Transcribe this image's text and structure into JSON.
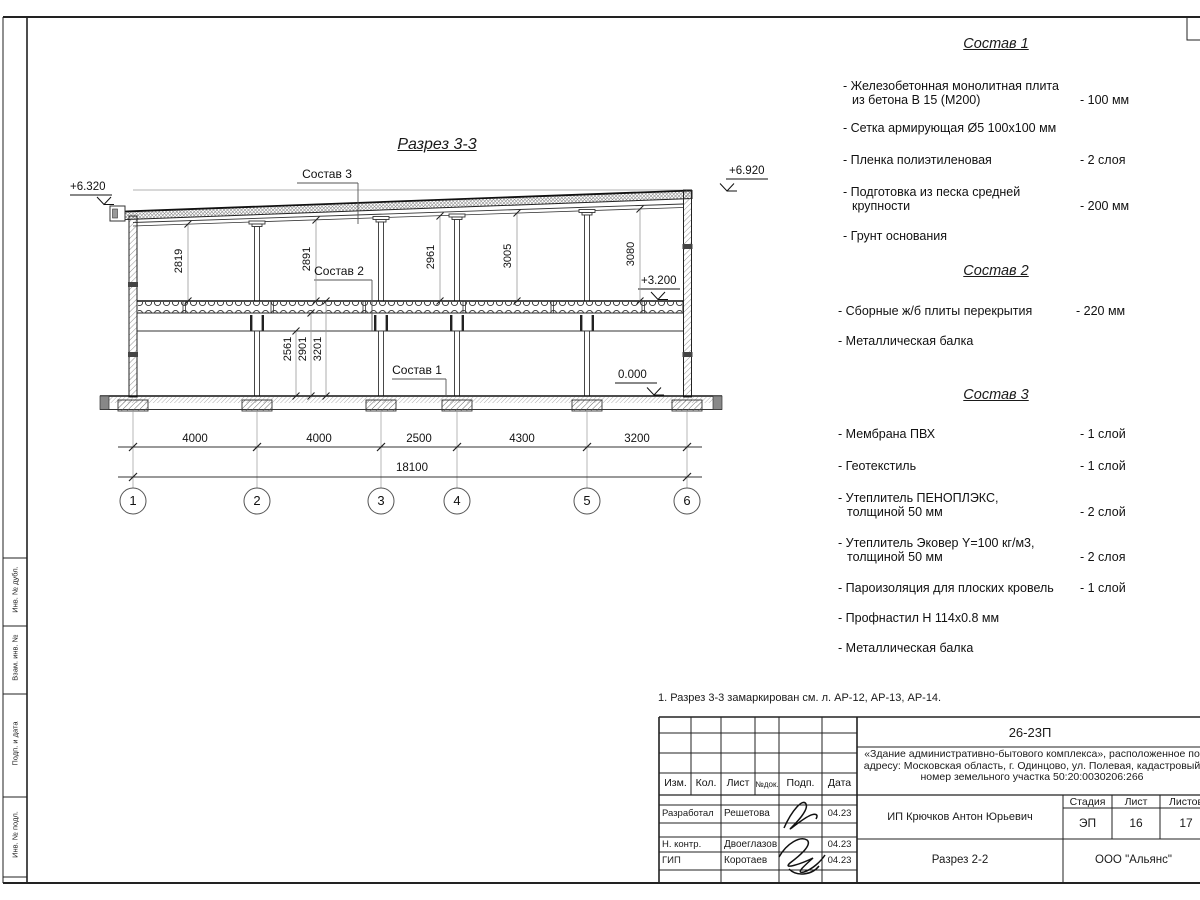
{
  "drawing": {
    "title": "Разрез 3-3",
    "callouts": {
      "c1": "Состав 1",
      "c2": "Состав 2",
      "c3": "Состав 3"
    },
    "elevations": {
      "eave_left": "+6.320",
      "top_right": "+6.920",
      "floor2": "+3.200",
      "ground": "0.000"
    },
    "dims_upper": [
      "2819",
      "2891",
      "2961",
      "3005",
      "3080"
    ],
    "dims_lower": [
      "2561",
      "2901",
      "3201"
    ],
    "dims_bottom": [
      "4000",
      "4000",
      "2500",
      "4300",
      "3200"
    ],
    "dim_total": "18100",
    "axes": [
      "1",
      "2",
      "3",
      "4",
      "5",
      "6"
    ]
  },
  "sostav1": {
    "title": "Состав 1",
    "items": [
      {
        "l1": "- Железобетонная монолитная плита",
        "l2": "из бетона В 15 (М200)",
        "v": "- 100 мм"
      },
      {
        "l1": "- Сетка армирующая Ø5 100х100 мм"
      },
      {
        "l1": "- Пленка полиэтиленовая",
        "v": "- 2 слоя"
      },
      {
        "l1": "- Подготовка из песка средней",
        "l2": "крупности",
        "v": "- 200 мм"
      },
      {
        "l1": "- Грунт основания"
      }
    ]
  },
  "sostav2": {
    "title": "Состав 2",
    "items": [
      {
        "l1": "- Сборные ж/б плиты перекрытия",
        "v": "- 220 мм"
      },
      {
        "l1": "- Металлическая балка"
      }
    ]
  },
  "sostav3": {
    "title": "Состав 3",
    "items": [
      {
        "l1": "- Мембрана ПВХ",
        "v": "- 1 слой"
      },
      {
        "l1": "- Геотекстиль",
        "v": "- 1 слой"
      },
      {
        "l1": "- Утеплитель ПЕНОПЛЭКС,",
        "l2": "толщиной 50 мм",
        "v": "- 2 слой"
      },
      {
        "l1": "- Утеплитель Эковер Y=100 кг/м3,",
        "l2": "толщиной 50 мм",
        "v": "- 2 слоя"
      },
      {
        "l1": "- Пароизоляция для плоских кровель",
        "v": "- 1 слой"
      },
      {
        "l1": "- Профнастил Н 114х0.8 мм"
      },
      {
        "l1": "- Металлическая балка"
      }
    ]
  },
  "note": "1. Разрез 3-3 замаркирован см. л. АР-12, АР-13, АР-14.",
  "left_margin": {
    "cells": [
      "Инв. № дубл.",
      "Взам. инв. №",
      "Подп. и дата",
      "Инв. № подл."
    ]
  },
  "title_block": {
    "code": "26-23П",
    "project": "«Здание административно-бытового комплекса», расположенное по адресу: Московская область, г. Одинцово, ул. Полевая, кадастровый номер земельного участка 50:20:0030206:266",
    "cols": [
      "Изм.",
      "Кол.",
      "Лист",
      "№док.",
      "Подп.",
      "Дата"
    ],
    "rows": [
      {
        "role": "Разработал",
        "name": "Решетова",
        "date": "04.23"
      },
      {
        "role": "Н. контр.",
        "name": "Двоеглазов",
        "date": "04.23"
      },
      {
        "role": "ГИП",
        "name": "Коротаев",
        "date": "04.23"
      }
    ],
    "client": "ИП Крючков Антон Юрьевич",
    "stage_label": "Стадия",
    "sheet_label": "Лист",
    "sheets_label": "Листов",
    "stage": "ЭП",
    "sheet": "16",
    "sheets": "17",
    "doc_title": "Разрез 2-2",
    "company": "ООО \"Альянс\""
  }
}
